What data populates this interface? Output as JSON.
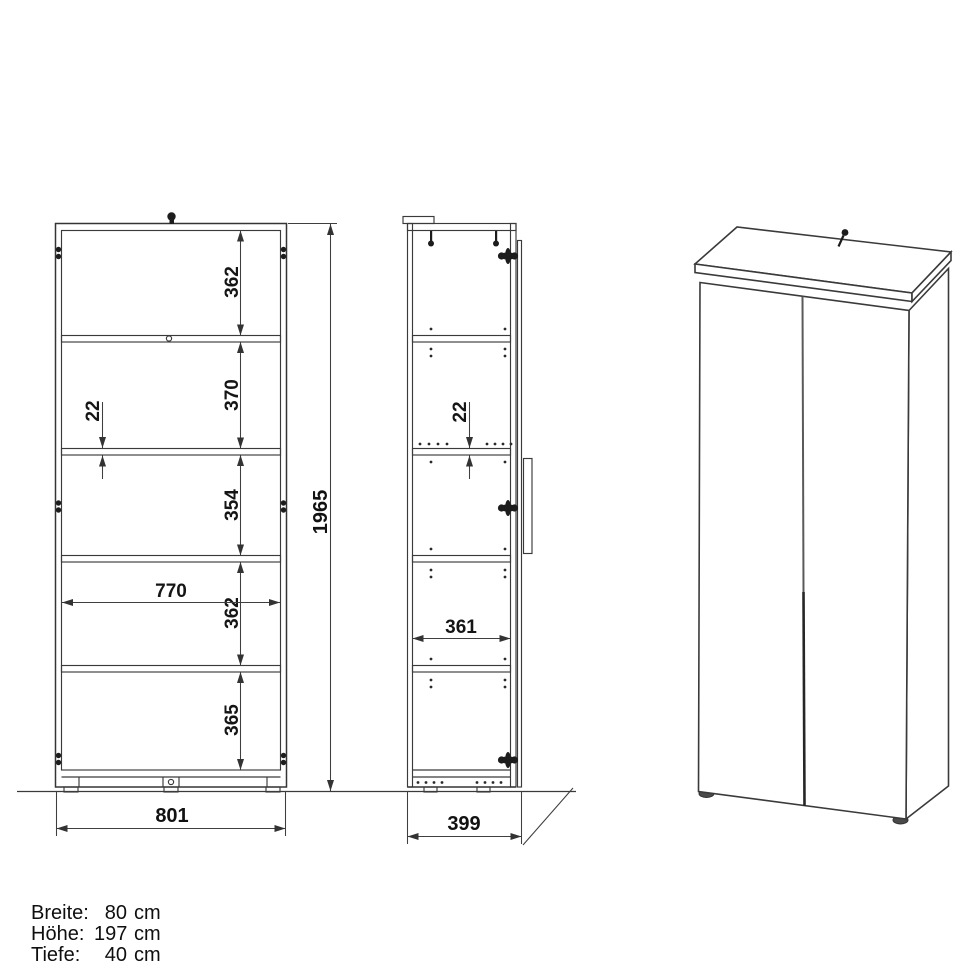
{
  "colors": {
    "line": "#3a3a3a",
    "dim_text": "#151515",
    "background": "#ffffff"
  },
  "views": {
    "front": {
      "section_dims": [
        "362",
        "370",
        "354",
        "362",
        "365"
      ],
      "shelf_thickness_dim": "22",
      "interior_width_dim": "770",
      "overall_width_dim": "801",
      "overall_height_dim": "1965"
    },
    "side": {
      "shelf_thickness_dim": "22",
      "interior_depth_dim": "361",
      "overall_depth_dim": "399"
    }
  },
  "specs": {
    "rows": [
      {
        "label": "Breite:",
        "value": "80",
        "unit": "cm"
      },
      {
        "label": "Höhe:",
        "value": "197",
        "unit": "cm"
      },
      {
        "label": "Tiefe:",
        "value": "40",
        "unit": "cm"
      }
    ]
  }
}
